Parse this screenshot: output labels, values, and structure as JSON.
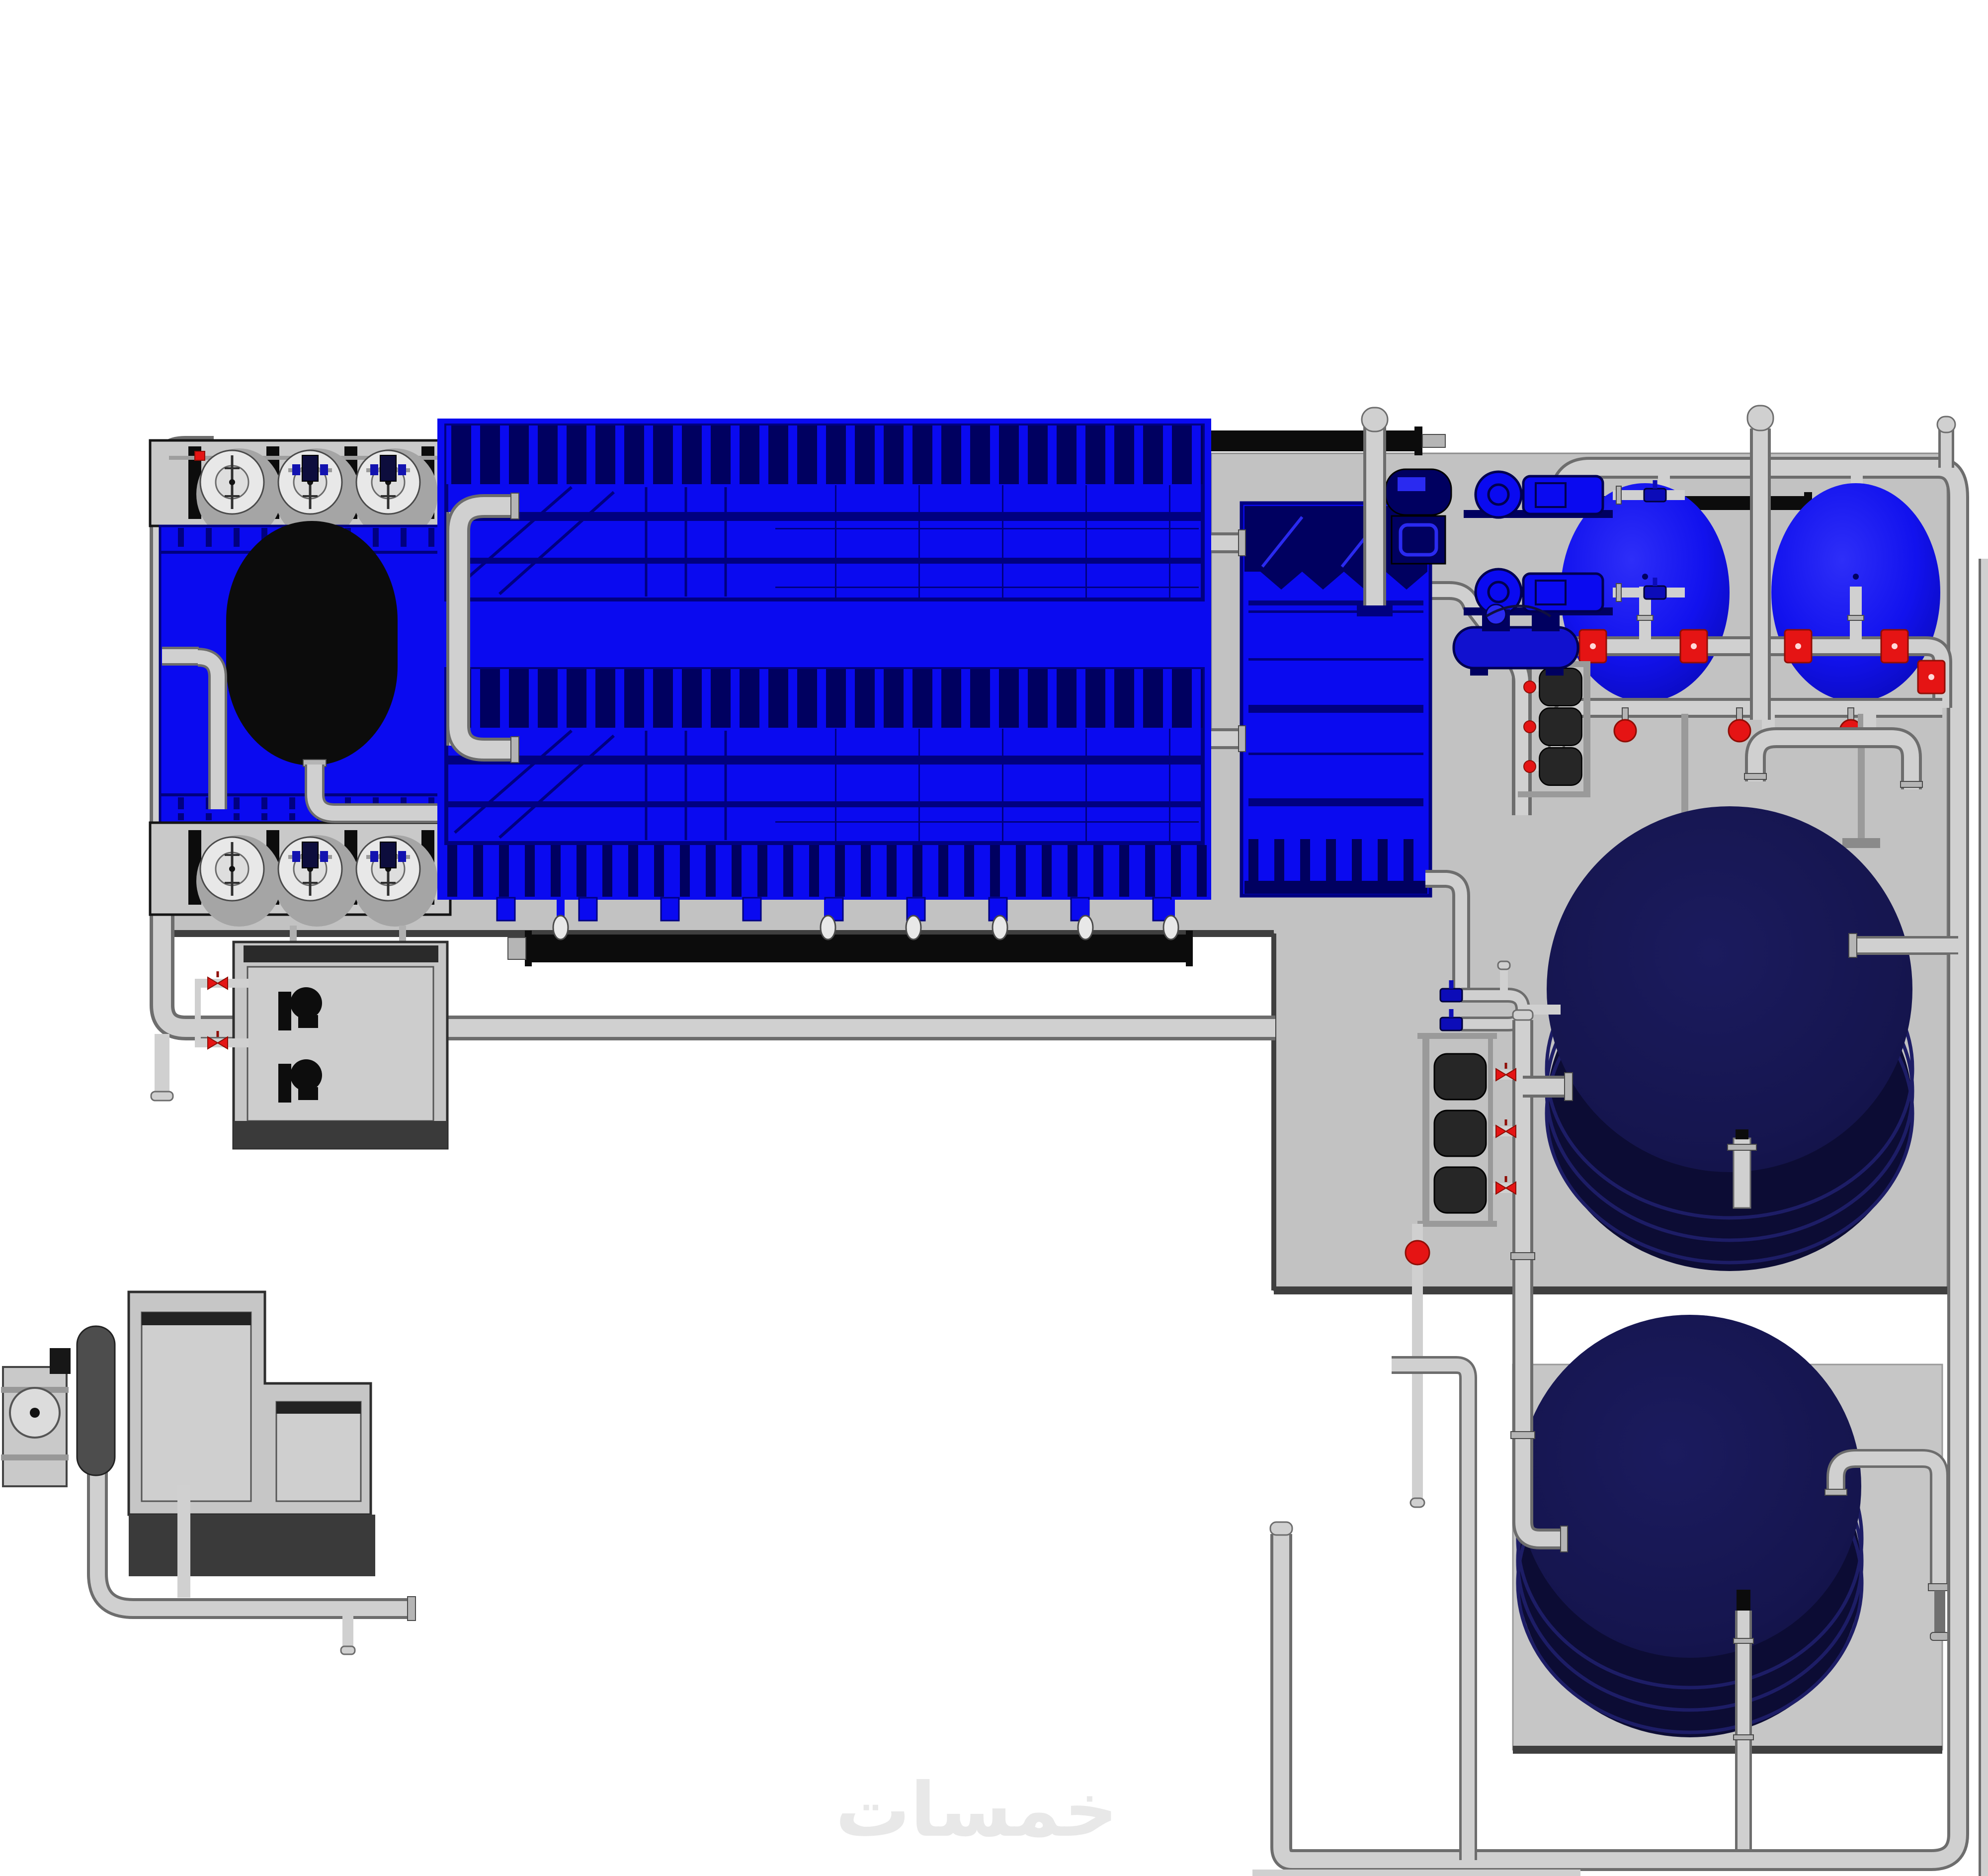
{
  "watermark": {
    "text": "خمسات"
  },
  "colors": {
    "background": "#ffffff",
    "platform": "#c2c2c2",
    "platform_edge": "#3f3f3f",
    "pad": "#c6c6c6",
    "equipment_blue": "#0a0af0",
    "navy": "#000080",
    "navy_dark": "#000060",
    "tank_top": "#15154e",
    "tank_side": "#0c0c34",
    "tank_ring": "#1d1d66",
    "sphere_blue": "#1212ee",
    "sphere_deep": "#0808b0",
    "pipe_light": "#d0d0d0",
    "pipe_mid": "#b5b5b5",
    "pipe_outline": "#6d6d6d",
    "black": "#0c0c0c",
    "valve_red": "#e51414",
    "red_dark": "#8f0e06",
    "fan_blade": "#e8e8e8",
    "fan_shadow": "#a5a5a5",
    "deck_gray": "#c9c9c9",
    "genset_body": "#c6c6c6",
    "genset_base": "#3a3a3a",
    "silencer": "#4d4d4d",
    "pump_dark": "#262626",
    "watermark": "#e8e8e8"
  },
  "equipment": [
    {
      "id": "cooling-tower",
      "kind": "induced-draft cooling tower",
      "fans": 6
    },
    {
      "id": "chiller-block",
      "kind": "packaged chiller units",
      "count": 2
    },
    {
      "id": "plate-tank-unit",
      "kind": "vertical tank / plate heat-exchanger unit",
      "count": 1
    },
    {
      "id": "pump-skid",
      "kind": "horizontal pump skid (blue)",
      "count": 2
    },
    {
      "id": "air-receiver",
      "kind": "horizontal receiver with compressor",
      "count": 1
    },
    {
      "id": "filter-vessel",
      "kind": "pressure filter dome vessel (blue)",
      "count": 2
    },
    {
      "id": "storage-tank",
      "kind": "large vertical storage tank (dark navy)",
      "count": 2
    },
    {
      "id": "pump-manifold",
      "kind": "inline pump manifold (3 pumps each)",
      "count": 2
    },
    {
      "id": "pump-box",
      "kind": "twin-pump cabinet",
      "count": 1
    },
    {
      "id": "genset",
      "kind": "generator / compressor package",
      "count": 1
    }
  ]
}
